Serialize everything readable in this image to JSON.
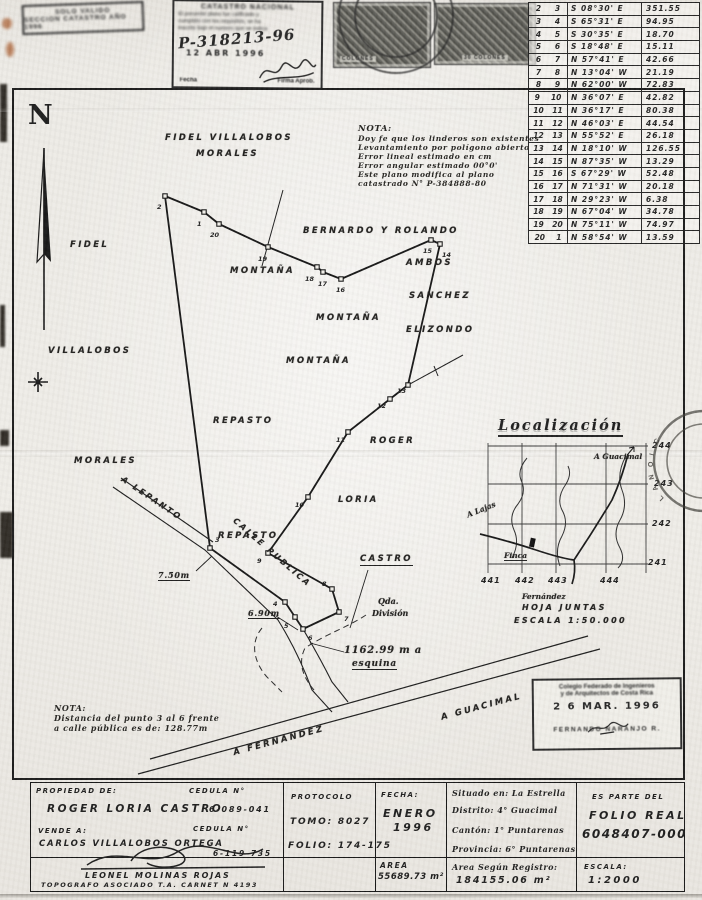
{
  "stamps": {
    "box1": {
      "line1": "SOLO VALIDO",
      "line2": "SECCION CATASTRO AÑO 1996"
    },
    "catastro": {
      "header": "CATASTRO NACIONAL",
      "line1": "El presente plano fue calificado y",
      "line2": "cumplido con los requisitos, se ha",
      "line3": "inscrito bajo el numero que se indica",
      "number": "P-318213-96",
      "date": "12 ABR 1996",
      "fecha_label": "Fecha",
      "firma_label": "Firma Aprob."
    },
    "revenue": {
      "caption_left": "COLONES",
      "caption_right": "30 COLONES"
    }
  },
  "bearing_table": {
    "rows": [
      {
        "from": "2",
        "to": "3",
        "bearing": "S 08°30' E",
        "dist": "351.55"
      },
      {
        "from": "3",
        "to": "4",
        "bearing": "S 65°31' E",
        "dist": "94.95"
      },
      {
        "from": "4",
        "to": "5",
        "bearing": "S 30°35' E",
        "dist": "18.70"
      },
      {
        "from": "5",
        "to": "6",
        "bearing": "S 18°48' E",
        "dist": "15.11"
      },
      {
        "from": "6",
        "to": "7",
        "bearing": "N 57°41' E",
        "dist": "42.66"
      },
      {
        "from": "7",
        "to": "8",
        "bearing": "N 13°04' W",
        "dist": "21.19"
      },
      {
        "from": "8",
        "to": "9",
        "bearing": "N 62°00' W",
        "dist": "72.83"
      },
      {
        "from": "9",
        "to": "10",
        "bearing": "N 36°07' E",
        "dist": "42.82"
      },
      {
        "from": "10",
        "to": "11",
        "bearing": "N 36°17' E",
        "dist": "80.38"
      },
      {
        "from": "11",
        "to": "12",
        "bearing": "N 46°03' E",
        "dist": "44.54"
      },
      {
        "from": "12",
        "to": "13",
        "bearing": "N 55°52' E",
        "dist": "26.18"
      },
      {
        "from": "13",
        "to": "14",
        "bearing": "N 18°10' W",
        "dist": "126.55"
      },
      {
        "from": "14",
        "to": "15",
        "bearing": "N 87°35' W",
        "dist": "13.29"
      },
      {
        "from": "15",
        "to": "16",
        "bearing": "S 67°29' W",
        "dist": "52.48"
      },
      {
        "from": "16",
        "to": "17",
        "bearing": "N 71°31' W",
        "dist": "20.18"
      },
      {
        "from": "17",
        "to": "18",
        "bearing": "N 29°23' W",
        "dist": "6.38"
      },
      {
        "from": "18",
        "to": "19",
        "bearing": "N 67°04' W",
        "dist": "34.78"
      },
      {
        "from": "19",
        "to": "20",
        "bearing": "N 75°11' W",
        "dist": "74.97"
      },
      {
        "from": "20",
        "to": "1",
        "bearing": "N 58°54' W",
        "dist": "13.59"
      }
    ]
  },
  "compass": {
    "n": "N"
  },
  "notes": {
    "top": {
      "title": "NOTA:",
      "lines": [
        "Doy fe que los linderos son existentes",
        "Levantamiento por polígono abierto",
        "Error lineal estimado en cm",
        "Error angular estimado 00°0'",
        "Este plano modifica al plano",
        "catastrado N° P-384888-80"
      ]
    },
    "bottom": {
      "title": "NOTA:",
      "line1": "Distancia del punto 3 al 6 frente",
      "line2": "a calle pública es de: 128.77m"
    }
  },
  "labels": {
    "fidel_top": "FIDEL  VILLALOBOS",
    "morales_top": "MORALES",
    "fidel_left": "FIDEL",
    "villalobos_left": "VILLALOBOS",
    "morales_left": "MORALES",
    "bernardo": "BERNARDO  Y  ROLANDO",
    "ambos": "AMBOS",
    "sanchez": "SANCHEZ",
    "elizondo": "ELIZONDO",
    "montana": "MONTAÑA",
    "repasto": "REPASTO",
    "roger": "ROGER",
    "loria": "LORIA",
    "castro": "CASTRO",
    "a_lepanto": "A LEPANTO",
    "calle_publica": "CALLE PUBLICA",
    "a_fernandez": "A FERNANDEZ",
    "a_guacimal": "A GUACIMAL",
    "qda": "Qda.",
    "division": "División",
    "dist_esquina": "1162.99 m a",
    "esquina": "esquina",
    "w750": "7.50m",
    "w690": "6.90m"
  },
  "plot": {
    "vertices": [
      {
        "n": "2",
        "x": 165,
        "y": 196,
        "lx": 157,
        "ly": 209
      },
      {
        "n": "1",
        "x": 204,
        "y": 212,
        "lx": 197,
        "ly": 226
      },
      {
        "n": "20",
        "x": 219,
        "y": 224,
        "lx": 210,
        "ly": 237
      },
      {
        "n": "19",
        "x": 268,
        "y": 247,
        "lx": 258,
        "ly": 261
      },
      {
        "n": "18",
        "x": 317,
        "y": 267,
        "lx": 305,
        "ly": 281
      },
      {
        "n": "17",
        "x": 323,
        "y": 272,
        "lx": 318,
        "ly": 286
      },
      {
        "n": "16",
        "x": 341,
        "y": 279,
        "lx": 336,
        "ly": 292
      },
      {
        "n": "15",
        "x": 431,
        "y": 240,
        "lx": 423,
        "ly": 253
      },
      {
        "n": "14",
        "x": 440,
        "y": 244,
        "lx": 442,
        "ly": 257
      },
      {
        "n": "13",
        "x": 408,
        "y": 385,
        "lx": 397,
        "ly": 393
      },
      {
        "n": "12",
        "x": 390,
        "y": 399,
        "lx": 377,
        "ly": 408
      },
      {
        "n": "11",
        "x": 348,
        "y": 432,
        "lx": 336,
        "ly": 442
      },
      {
        "n": "10",
        "x": 308,
        "y": 497,
        "lx": 295,
        "ly": 507
      },
      {
        "n": "9",
        "x": 268,
        "y": 553,
        "lx": 257,
        "ly": 563
      },
      {
        "n": "8",
        "x": 332,
        "y": 589,
        "lx": 322,
        "ly": 586
      },
      {
        "n": "7",
        "x": 339,
        "y": 612,
        "lx": 344,
        "ly": 621
      },
      {
        "n": "6",
        "x": 303,
        "y": 629,
        "lx": 308,
        "ly": 640
      },
      {
        "n": "5",
        "x": 295,
        "y": 617,
        "lx": 284,
        "ly": 628
      },
      {
        "n": "4",
        "x": 285,
        "y": 602,
        "lx": 273,
        "ly": 606
      },
      {
        "n": "3",
        "x": 210,
        "y": 548,
        "lx": 215,
        "ly": 542
      }
    ]
  },
  "localizacion": {
    "title": "Localización",
    "grid_right": [
      "244",
      "243",
      "242",
      "241"
    ],
    "grid_bottom": [
      "441",
      "442",
      "443",
      "444"
    ],
    "a_guacimal": "A Guacimal",
    "a_lajas": "A Lajas",
    "finca": "Finca",
    "fernandez": "Fernández",
    "hoja": "HOJA  JUNTAS",
    "escala": "ESCALA  1:50.000"
  },
  "cfia_stamp": {
    "line1": "Colegio Federado de Ingenieros",
    "line2": "y de Arquitectos de Costa Rica",
    "date": "2 6 MAR. 1996",
    "name": "FERNANDO NARANJO R."
  },
  "title_block": {
    "propiedad_label": "PROPIEDAD DE:",
    "cedula_label": "CEDULA N°",
    "owner": "ROGER  LORIA  CASTRO",
    "owner_cedula": "6-089-041",
    "vende_label": "VENDE A:",
    "cedula2_label": "CEDULA N°",
    "buyer": "CARLOS  VILLALOBOS  ORTEGA",
    "buyer_cedula": "6-119-735",
    "surveyor": "LEONEL  MOLINAS  ROJAS",
    "surveyor_title": "TOPOGRAFO  ASOCIADO  T.A.  CARNET N 4193",
    "protocolo_label": "PROTOCOLO",
    "tomo": "TOMO:  8027",
    "folio": "FOLIO:  174-175",
    "fecha_label": "FECHA:",
    "fecha_mes": "ENERO",
    "fecha_ano": "1996",
    "situado": "Situado en: La Estrella",
    "distrito": "Distrito: 4° Guacimal",
    "canton": "Cantón: 1° Puntarenas",
    "provincia": "Provincia: 6° Puntarenas",
    "area_label": "AREA",
    "area": "55689.73 m²",
    "area_reg_label": "Area Según Registro:",
    "area_reg": "184155.06 m²",
    "es_parte": "ES PARTE DEL",
    "folio_real": "FOLIO REAL",
    "folio_real_num": "6048407-000",
    "escala_label": "ESCALA:",
    "escala": "1:2000"
  }
}
